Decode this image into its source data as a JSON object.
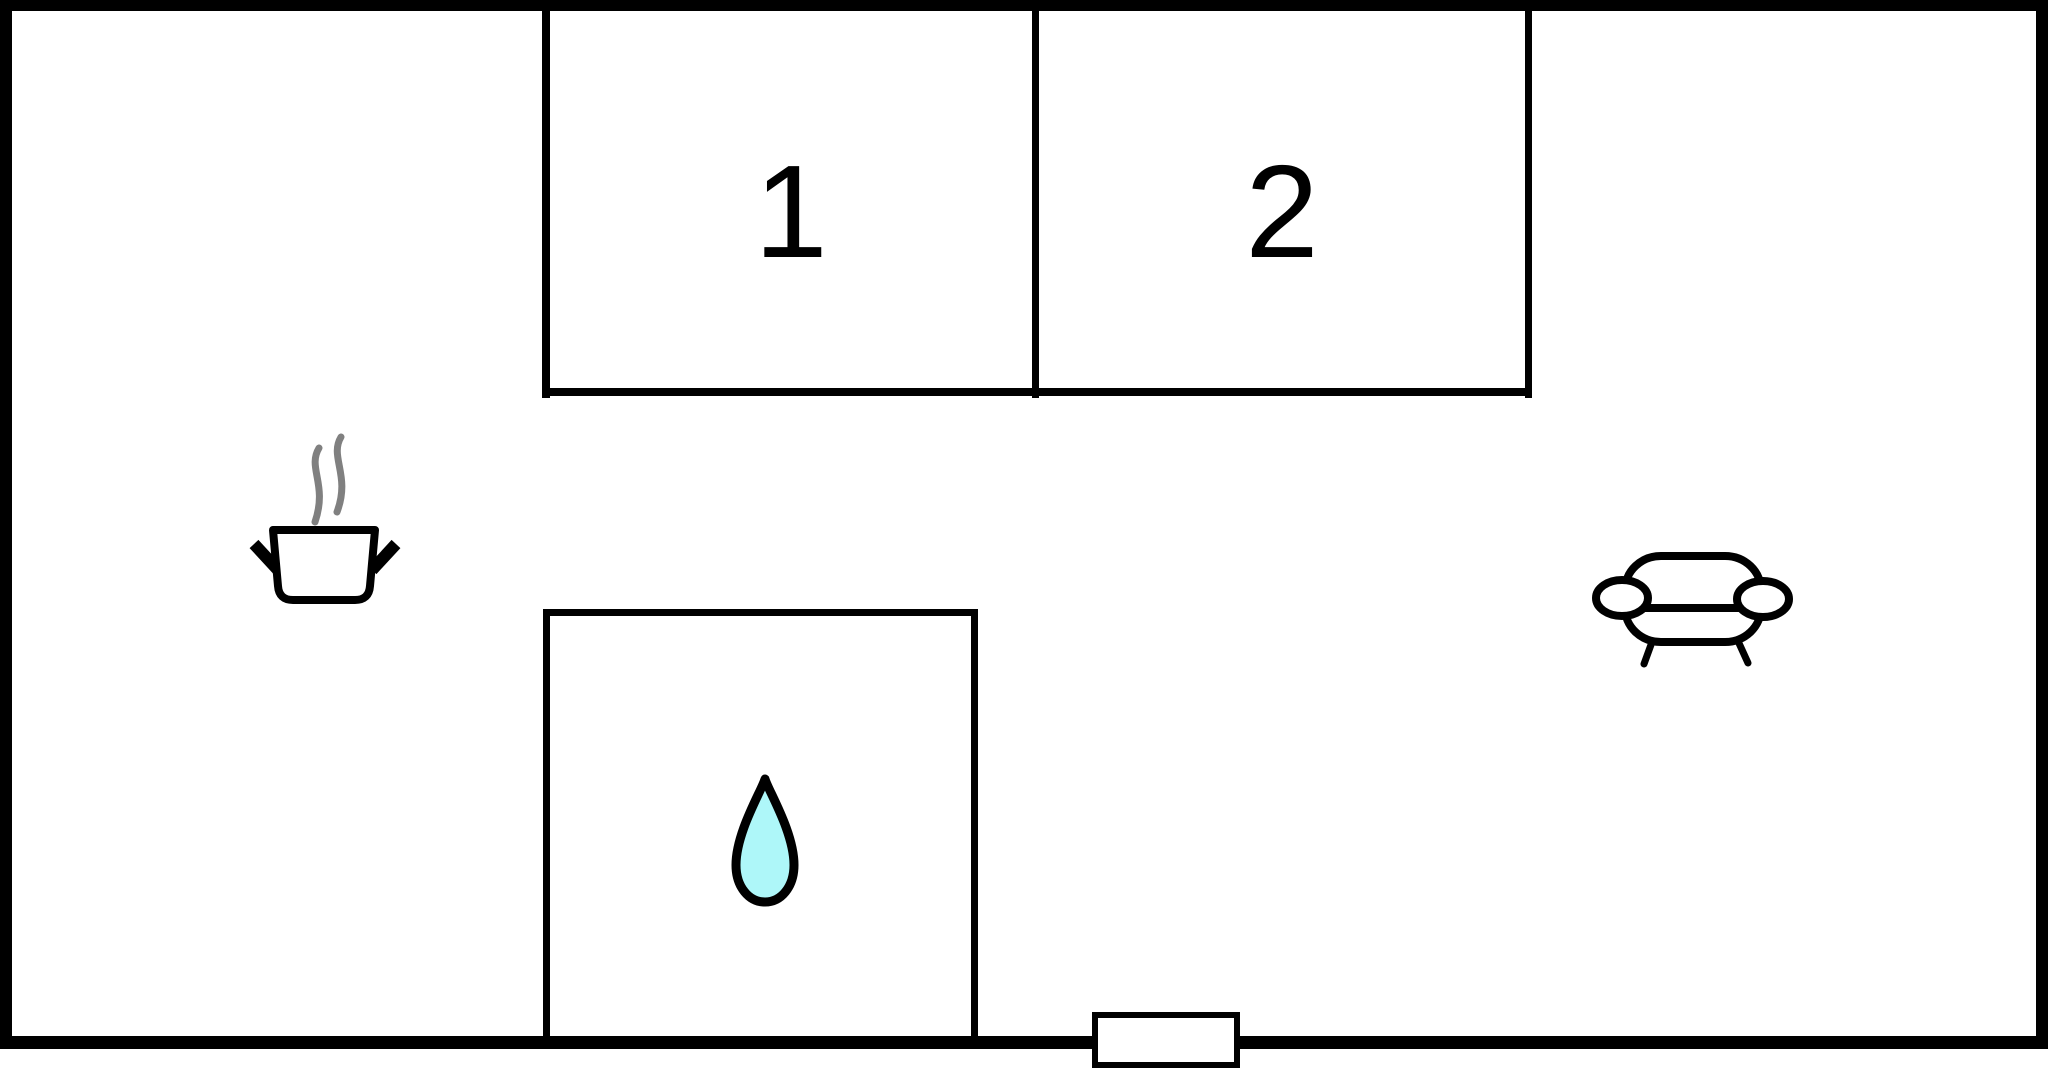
{
  "plan": {
    "rooms": [
      {
        "id": "room-1",
        "label": "1"
      },
      {
        "id": "room-2",
        "label": "2"
      }
    ],
    "icons": [
      {
        "name": "steam-pot-icon"
      },
      {
        "name": "water-drop-icon"
      },
      {
        "name": "sofa-icon"
      },
      {
        "name": "door-marker"
      }
    ],
    "colors": {
      "wall": "#000000",
      "background": "#ffffff",
      "steam": "#808080",
      "water_drop_fill": "#aef7f9",
      "icon_outline": "#000000"
    }
  }
}
